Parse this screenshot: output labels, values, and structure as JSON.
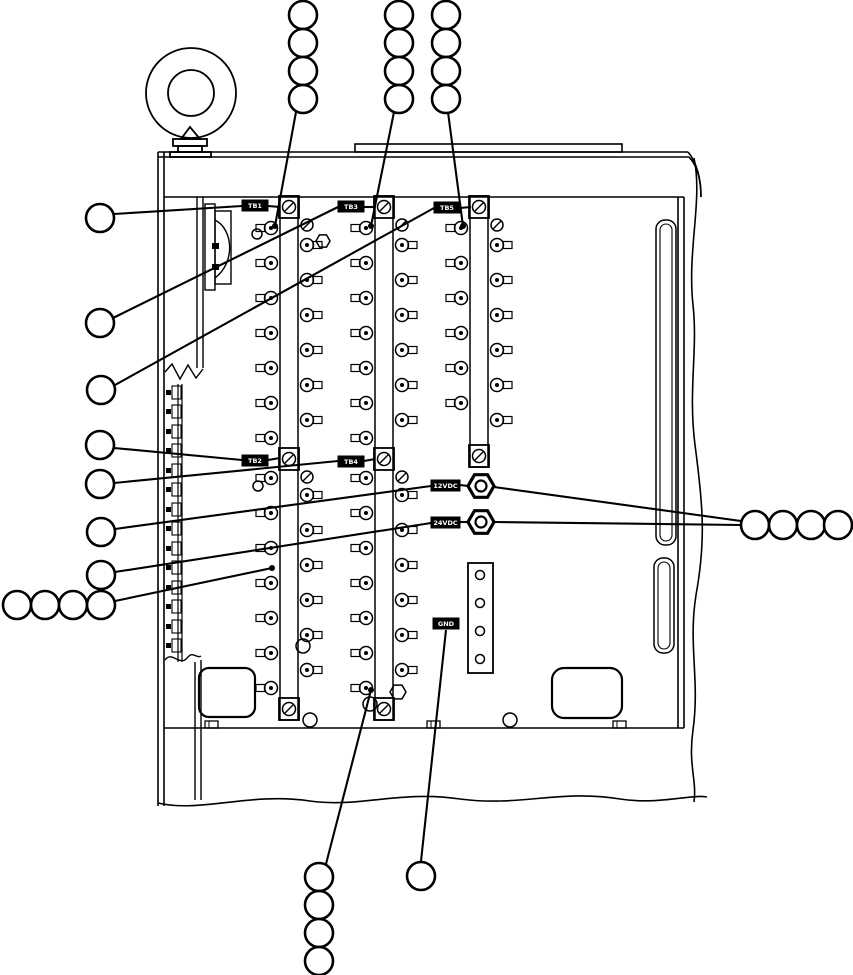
{
  "colors": {
    "line": "#000000",
    "background": "#ffffff",
    "label_bg": "#000000",
    "label_text": "#ffffff"
  },
  "diagram": {
    "labels": [
      {
        "id": "tb1",
        "text": "TB1",
        "x": 242,
        "y": 200,
        "w": 26,
        "h": 11
      },
      {
        "id": "tb3",
        "text": "TB3",
        "x": 338,
        "y": 201,
        "w": 26,
        "h": 11
      },
      {
        "id": "tb5",
        "text": "TB5",
        "x": 434,
        "y": 202,
        "w": 26,
        "h": 11
      },
      {
        "id": "tb2",
        "text": "TB2",
        "x": 242,
        "y": 455,
        "w": 26,
        "h": 11
      },
      {
        "id": "tb4",
        "text": "TB4",
        "x": 338,
        "y": 456,
        "w": 26,
        "h": 11
      },
      {
        "id": "12vdc",
        "text": "12VDC",
        "x": 431,
        "y": 480,
        "w": 29,
        "h": 11
      },
      {
        "id": "24vdc",
        "text": "24VDC",
        "x": 431,
        "y": 517,
        "w": 29,
        "h": 11
      },
      {
        "id": "gnd",
        "text": "GND",
        "x": 433,
        "y": 618,
        "w": 26,
        "h": 11
      }
    ],
    "callout_groups": [
      {
        "name": "top-column-1",
        "r": 14,
        "circles": [
          [
            303,
            15
          ],
          [
            303,
            43
          ],
          [
            303,
            71
          ],
          [
            303,
            99
          ]
        ]
      },
      {
        "name": "top-column-2",
        "r": 14,
        "circles": [
          [
            399,
            15
          ],
          [
            399,
            43
          ],
          [
            399,
            71
          ],
          [
            399,
            99
          ]
        ]
      },
      {
        "name": "top-column-3",
        "r": 14,
        "circles": [
          [
            446,
            15
          ],
          [
            446,
            43
          ],
          [
            446,
            71
          ],
          [
            446,
            99
          ]
        ]
      },
      {
        "name": "left-singles",
        "r": 14,
        "circles": [
          [
            100,
            218
          ],
          [
            100,
            323
          ],
          [
            101,
            390
          ],
          [
            100,
            445
          ],
          [
            100,
            484
          ],
          [
            101,
            532
          ],
          [
            101,
            575
          ]
        ]
      },
      {
        "name": "left-row",
        "r": 14,
        "circles": [
          [
            17,
            605
          ],
          [
            45,
            605
          ],
          [
            73,
            605
          ],
          [
            101,
            605
          ]
        ]
      },
      {
        "name": "right-row",
        "r": 14,
        "circles": [
          [
            755,
            525
          ],
          [
            783,
            525
          ],
          [
            811,
            525
          ],
          [
            838,
            525
          ]
        ]
      },
      {
        "name": "bottom-column",
        "r": 14,
        "circles": [
          [
            319,
            877
          ],
          [
            319,
            905
          ],
          [
            319,
            933
          ],
          [
            319,
            961
          ]
        ]
      },
      {
        "name": "bottom-single",
        "r": 14,
        "circles": [
          [
            421,
            876
          ]
        ]
      }
    ],
    "leaders": [
      {
        "x1": 296,
        "y1": 112,
        "x2": 275,
        "y2": 226,
        "dot": true
      },
      {
        "x1": 394,
        "y1": 112,
        "x2": 371,
        "y2": 226,
        "dot": true
      },
      {
        "x1": 448,
        "y1": 112,
        "x2": 463,
        "y2": 226,
        "dot": true
      },
      {
        "x1": 115,
        "y1": 601,
        "x2": 272,
        "y2": 568,
        "dot": true
      },
      {
        "x1": 326,
        "y1": 864,
        "x2": 371,
        "y2": 690,
        "dot": true
      },
      {
        "x1": 114,
        "y1": 214,
        "x2": 242,
        "y2": 206,
        "dot": false
      },
      {
        "x1": 268,
        "y1": 206,
        "x2": 280,
        "y2": 207,
        "dot": false
      },
      {
        "x1": 113,
        "y1": 318,
        "x2": 338,
        "y2": 207,
        "dot": false
      },
      {
        "x1": 364,
        "y1": 207,
        "x2": 375,
        "y2": 207,
        "dot": false
      },
      {
        "x1": 115,
        "y1": 385,
        "x2": 434,
        "y2": 208,
        "dot": false
      },
      {
        "x1": 460,
        "y1": 208,
        "x2": 471,
        "y2": 207,
        "dot": false
      },
      {
        "x1": 114,
        "y1": 448,
        "x2": 242,
        "y2": 460,
        "dot": false
      },
      {
        "x1": 268,
        "y1": 460,
        "x2": 280,
        "y2": 458,
        "dot": false
      },
      {
        "x1": 114,
        "y1": 483,
        "x2": 338,
        "y2": 461,
        "dot": false
      },
      {
        "x1": 364,
        "y1": 461,
        "x2": 375,
        "y2": 459,
        "dot": false
      },
      {
        "x1": 115,
        "y1": 529,
        "x2": 431,
        "y2": 486,
        "dot": false
      },
      {
        "x1": 460,
        "y1": 485,
        "x2": 468,
        "y2": 486,
        "dot": false
      },
      {
        "x1": 115,
        "y1": 572,
        "x2": 431,
        "y2": 523,
        "dot": false
      },
      {
        "x1": 460,
        "y1": 522,
        "x2": 468,
        "y2": 522,
        "dot": false
      },
      {
        "x1": 494,
        "y1": 487,
        "x2": 741,
        "y2": 521,
        "dot": false
      },
      {
        "x1": 494,
        "y1": 522,
        "x2": 741,
        "y2": 525,
        "dot": false
      },
      {
        "x1": 446,
        "y1": 630,
        "x2": 421,
        "y2": 861,
        "dot": false
      }
    ],
    "strips": [
      {
        "id": "terminal-strip-1",
        "bar_x": 280,
        "boxes": [
          196,
          448,
          698
        ],
        "sections": [
          {
            "slash_y": 225,
            "lug_ys": [
              228,
              263,
              298,
              333,
              368,
              403,
              438
            ],
            "screw_ys": [
              245,
              280,
              315,
              350,
              385,
              420
            ]
          },
          {
            "slash_y": 477,
            "lug_ys": [
              478,
              513,
              548,
              583,
              618,
              653,
              688
            ],
            "screw_ys": [
              495,
              530,
              565,
              600,
              635,
              670
            ]
          }
        ]
      },
      {
        "id": "terminal-strip-2",
        "bar_x": 375,
        "boxes": [
          196,
          448,
          698
        ],
        "sections": [
          {
            "slash_y": 225,
            "lug_ys": [
              228,
              263,
              298,
              333,
              368,
              403,
              438
            ],
            "screw_ys": [
              245,
              280,
              315,
              350,
              385,
              420
            ]
          },
          {
            "slash_y": 477,
            "lug_ys": [
              478,
              513,
              548,
              583,
              618,
              653,
              688
            ],
            "screw_ys": [
              495,
              530,
              565,
              600,
              635,
              670
            ]
          }
        ]
      },
      {
        "id": "terminal-strip-3",
        "bar_x": 470,
        "boxes": [
          196,
          445
        ],
        "sections": [
          {
            "slash_y": 225,
            "lug_ys": [
              228,
              263,
              298,
              333,
              368,
              403
            ],
            "screw_ys": [
              245,
              280,
              315,
              350,
              385,
              420
            ]
          }
        ]
      }
    ],
    "din_rail": {
      "line_x": [
        178,
        182
      ],
      "y0": 384,
      "y1": 662,
      "blocks_y": [
        386,
        405,
        425,
        444,
        464,
        483,
        503,
        522,
        542,
        561,
        581,
        600,
        620,
        639
      ]
    },
    "rail_tabs": {
      "y": 721,
      "w": 13,
      "h": 7,
      "xs": [
        205,
        427,
        613
      ]
    },
    "jacks": {
      "r": 13,
      "positions": [
        [
          481,
          486
        ],
        [
          481,
          522
        ]
      ]
    },
    "plate": {
      "x": 468,
      "y": 563,
      "w": 25,
      "h": 110,
      "holes": [
        [
          480,
          575
        ],
        [
          480,
          603
        ],
        [
          480,
          631
        ],
        [
          480,
          659
        ]
      ]
    },
    "extra_circles": [
      [
        257,
        234,
        5
      ],
      [
        258,
        486,
        5
      ],
      [
        303,
        646,
        7
      ],
      [
        310,
        720,
        7
      ],
      [
        370,
        704,
        7
      ],
      [
        510,
        720,
        7
      ]
    ],
    "extra_hexes": [
      [
        323,
        241,
        7
      ],
      [
        398,
        692,
        8
      ]
    ]
  }
}
